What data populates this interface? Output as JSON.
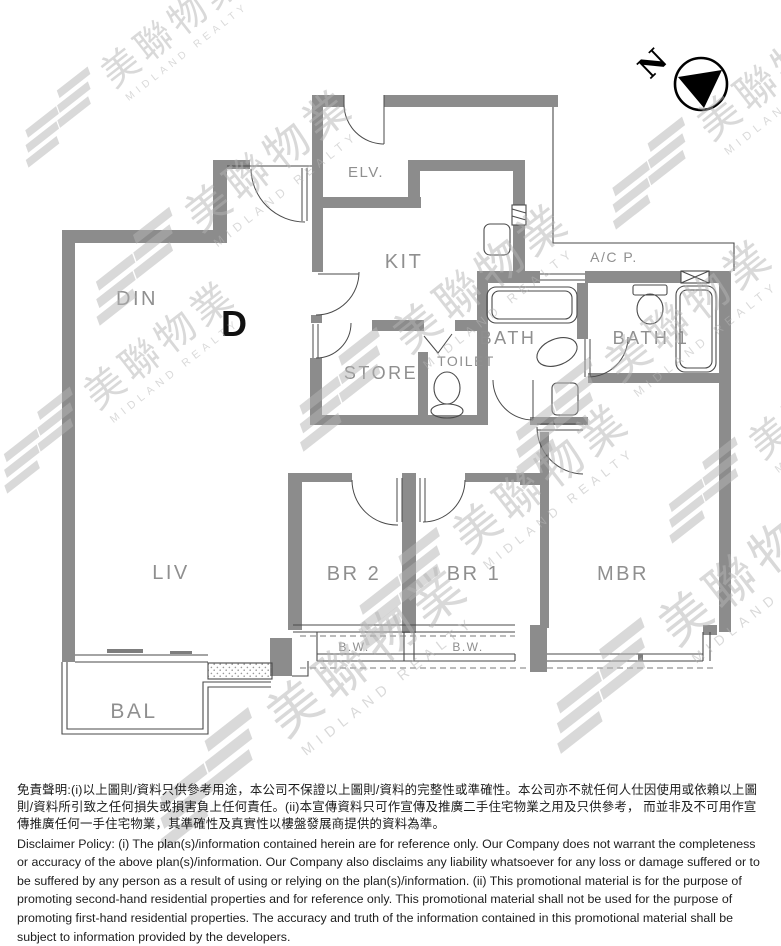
{
  "floor_plan": {
    "unit_label": "D",
    "rooms": {
      "din": "DIN",
      "elv": "ELV.",
      "kit": "KIT",
      "store": "STORE",
      "toilet": "TOILET",
      "bath": "BATH",
      "bath1": "BATH 1",
      "acp": "A/C P.",
      "liv": "LIV",
      "br2": "BR 2",
      "br1": "BR 1",
      "mbr": "MBR",
      "bw": "B.W.",
      "bal": "BAL"
    },
    "fixtures": [
      "bathtub",
      "toilet",
      "wash-basin",
      "kitchen-sink",
      "cabinet",
      "window",
      "bay-window",
      "balcony",
      "ac-platform"
    ]
  },
  "compass": {
    "label": "N"
  },
  "watermark": {
    "brand_cjk": "美聯物業",
    "brand_en": "MIDLAND REALTY"
  },
  "disclaimer": {
    "zh": "免責聲明:(i)以上圖則/資料只供參考用途，本公司不保證以上圖則/資料的完整性或準確性。本公司亦不就任何人仕因使用或依賴以上圖則/資料所引致之任何損失或損害負上任何責任。(ii)本宣傳資料只可作宣傳及推廣二手住宅物業之用及只供參考， 而並非及不可用作宣傳推廣任何一手住宅物業，其準確性及真實性以樓盤發展商提供的資料為準。",
    "en": "Disclaimer Policy: (i) The plan(s)/information contained herein are for reference only. Our Company does not warrant the completeness or accuracy of the above plan(s)/information. Our Company also disclaims any liability whatsoever for any loss or damage suffered or to be suffered by any person as a result of using or relying on the plan(s)/information. (ii) This promotional material is for the purpose of promoting second-hand residential properties and for reference only. This promotional material shall not be used for the purpose of promoting first-hand residential properties. The accuracy and truth of the information contained in this promotional material shall be subject to information provided by the developers."
  },
  "colors": {
    "wall": "#8c8c8c",
    "thin_line": "#4a4a4a",
    "label": "#8f8f8f",
    "ink": "#111111",
    "watermark": "#b4b4b4"
  }
}
